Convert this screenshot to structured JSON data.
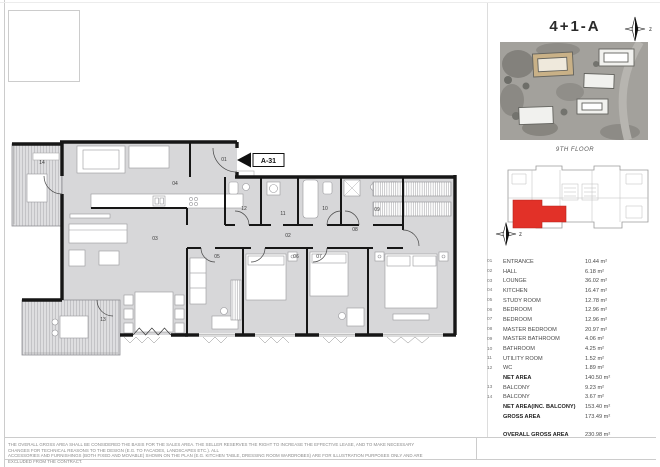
{
  "page": {
    "title": "4+1-A",
    "floor_label": "9TH FLOOR",
    "compass_label": "z",
    "disclaimer_line1": "THE OVERALL GROSS AREA SHALL BE CONSIDERED THE BASIS FOR THE SALES AREA. THE SELLER RESERVES THE RIGHT TO INCREASE THE EFFECTIVE LEASE, AND TO MAKE NECESSARY CHANGES FOR TECHNICAL REASONS TO THE DESIGN (E.G. TO FACADES, LANDSCAPES ETC.). ALL",
    "disclaimer_line2": "ACCESSORIES AND FURNISHINGS (BOTH FIXED AND MOVABLE) SHOWN ON THE PLAN (E.G. KITCHEN TABLE, DRESSING ROOM WARDROBES) ARE FOR ILLUSTRATION PURPOSES ONLY AND ARE EXCLUDED FROM THE CONTRACT."
  },
  "plan": {
    "marker": "A-31",
    "labels": {
      "r01": "01",
      "r02": "02",
      "r03": "03",
      "r04": "04",
      "r05": "05",
      "r06": "06",
      "r07": "07",
      "r08": "08",
      "r09": "09",
      "r10": "10",
      "r11": "11",
      "r12": "12",
      "r13": "13",
      "r14": "14"
    }
  },
  "colors": {
    "highlight_red": "#e23128",
    "wall_black": "#161616",
    "room_fill": "#d7d7d9"
  },
  "area_table": {
    "rows": [
      {
        "no": "01",
        "name": "ENTRANCE",
        "value": "10.44 m²",
        "bold": false
      },
      {
        "no": "02",
        "name": "HALL",
        "value": "6.18 m²",
        "bold": false
      },
      {
        "no": "03",
        "name": "LOUNGE",
        "value": "36.02 m²",
        "bold": false
      },
      {
        "no": "04",
        "name": "KITCHEN",
        "value": "16.47 m²",
        "bold": false
      },
      {
        "no": "05",
        "name": "STUDY ROOM",
        "value": "12.78 m²",
        "bold": false
      },
      {
        "no": "06",
        "name": "BEDROOM",
        "value": "12.96 m²",
        "bold": false
      },
      {
        "no": "07",
        "name": "BEDROOM",
        "value": "12.96 m²",
        "bold": false
      },
      {
        "no": "08",
        "name": "MASTER BEDROOM",
        "value": "20.97 m²",
        "bold": false
      },
      {
        "no": "09",
        "name": "MASTER BATHROOM",
        "value": "4.06 m²",
        "bold": false
      },
      {
        "no": "10",
        "name": "BATHROOM",
        "value": "4.25 m²",
        "bold": false
      },
      {
        "no": "11",
        "name": "UTILITY ROOM",
        "value": "1.52 m²",
        "bold": false
      },
      {
        "no": "12",
        "name": "WC",
        "value": "1.89 m²",
        "bold": false
      },
      {
        "no": "",
        "name": "NET AREA",
        "value": "140.50 m²",
        "bold": true
      },
      {
        "no": "13",
        "name": "BALCONY",
        "value": "9.23 m²",
        "bold": false
      },
      {
        "no": "14",
        "name": "BALCONY",
        "value": "3.67 m²",
        "bold": false
      },
      {
        "no": "",
        "name": "NET AREA(INC. BALCONY)",
        "value": "153.40 m²",
        "bold": true
      },
      {
        "no": "",
        "name": "GROSS AREA",
        "value": "173.49 m²",
        "bold": true
      },
      {
        "no": "",
        "name": "OVERALL GROSS AREA",
        "value": "230.98 m²",
        "bold": true,
        "gap": true
      }
    ]
  }
}
